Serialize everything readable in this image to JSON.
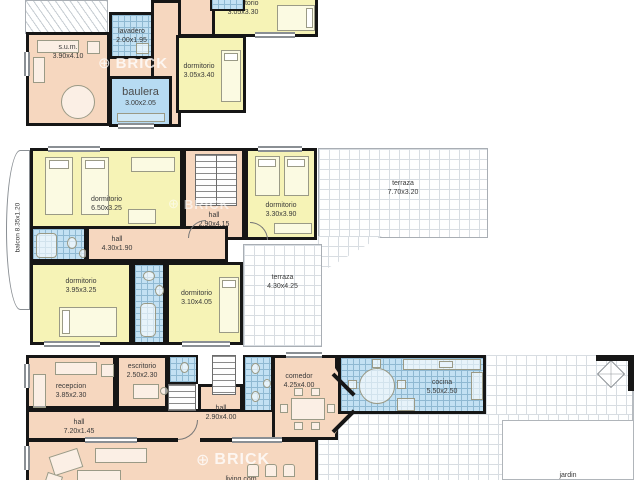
{
  "watermark": {
    "symbol": "⊕",
    "text": "BRICK"
  },
  "colors": {
    "wall": "#161616",
    "room_peach": "#f6d7bf",
    "room_yellow": "#f6f3b6",
    "room_blue": "#b7dbf2",
    "tile_line": "#8fb9d2"
  },
  "plans": {
    "upper": {
      "rooms": {
        "sum": {
          "name": "s.u.m.",
          "dims": "3.90x4.10"
        },
        "lavadero": {
          "name": "lavadero",
          "dims": "2.00x1.95"
        },
        "baulera": {
          "name": "baulera",
          "dims": "3.00x2.05"
        },
        "dormitorio_a": {
          "name": "dormitorio",
          "dims": "3.05x3.40"
        },
        "dormitorio_b": {
          "name": "dormitorio",
          "dims": "3.05x3.30"
        }
      }
    },
    "first": {
      "rooms": {
        "balcon": {
          "name": "balcon",
          "dims": "8.35x1.20"
        },
        "dormitorio_gr": {
          "name": "dormitorio",
          "dims": "6.50x3.25"
        },
        "hall_escalera": {
          "name": "hall",
          "dims": "2.90x4.15"
        },
        "dormitorio_ne": {
          "name": "dormitorio",
          "dims": "3.30x3.90"
        },
        "terraza_norte": {
          "name": "terraza",
          "dims": "7.70x3.20"
        },
        "hall_pasillo": {
          "name": "hall",
          "dims": "4.30x1.90"
        },
        "dormitorio_so": {
          "name": "dormitorio",
          "dims": "3.95x3.25"
        },
        "dormitorio_se": {
          "name": "dormitorio",
          "dims": "3.10x4.05"
        },
        "terraza_sur": {
          "name": "terraza",
          "dims": "4.30x4.25"
        }
      }
    },
    "ground": {
      "rooms": {
        "recepcion": {
          "name": "recepcion",
          "dims": "3.85x2.30"
        },
        "escritorio": {
          "name": "escritorio",
          "dims": "2.50x2.30"
        },
        "hall_largo": {
          "name": "hall",
          "dims": "7.20x1.45"
        },
        "hall_central": {
          "name": "hall",
          "dims": "2.90x4.00"
        },
        "comedor": {
          "name": "comedor",
          "dims": "4.25x4.00"
        },
        "cocina": {
          "name": "cocina",
          "dims": "5.50x2.50"
        },
        "living": {
          "name": "living com"
        },
        "jardin": {
          "name": "jardin"
        }
      }
    }
  }
}
